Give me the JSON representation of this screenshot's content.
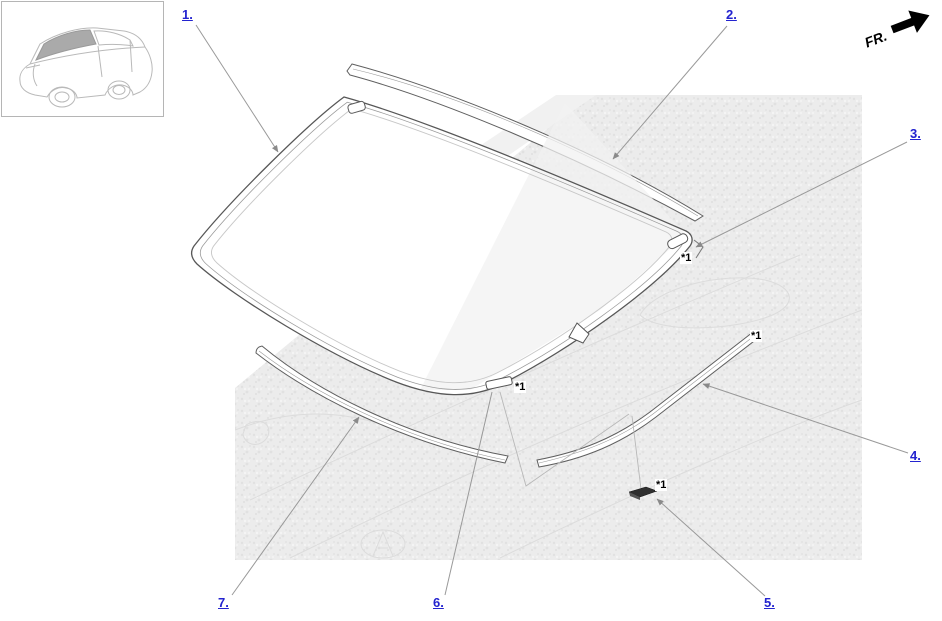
{
  "orientation": {
    "front_label": "FR."
  },
  "footnote": {
    "marker": "*1"
  },
  "callouts": [
    {
      "ref": "1",
      "label": "1."
    },
    {
      "ref": "2",
      "label": "2."
    },
    {
      "ref": "3",
      "label": "3."
    },
    {
      "ref": "4",
      "label": "4."
    },
    {
      "ref": "5",
      "label": "5."
    },
    {
      "ref": "6",
      "label": "6."
    },
    {
      "ref": "7",
      "label": "7."
    }
  ],
  "colors": {
    "callout_link": "#2323cf",
    "part_line": "#5a5a5a",
    "leader_line": "#999999",
    "body_texture": "#ececec",
    "front_arrow": "#000000",
    "thumbnail_glass": "#aaaaaa"
  }
}
